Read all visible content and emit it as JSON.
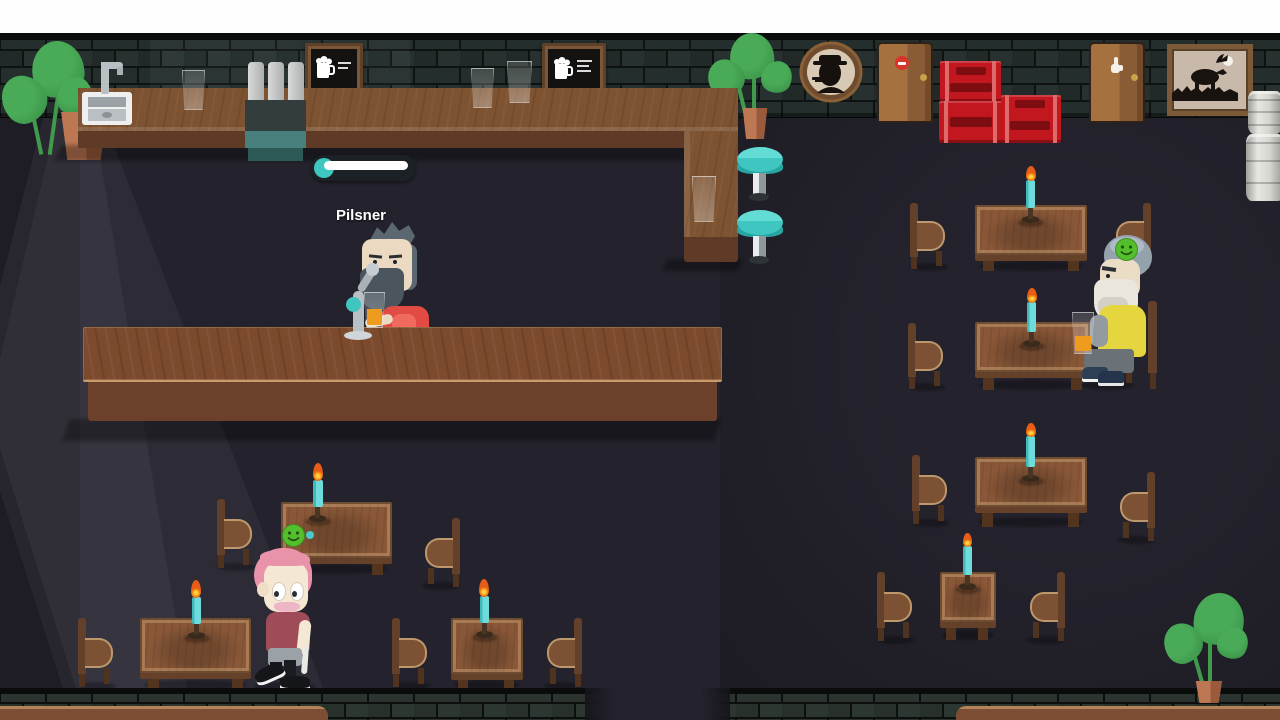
{
  "hud": {
    "beer_label": "Pilsner",
    "progress": {
      "percent": 88,
      "track_color": "#1c2125",
      "fill_color": "#ffffff",
      "bubble_color": "#3cc8c2"
    }
  },
  "characters": {
    "bartender": {
      "role": "bartender",
      "action": "pouring-beer",
      "shirt_color": "#e24a44",
      "hair_color": "#5c6871"
    },
    "seated_customer": {
      "mood": "happy",
      "shirt_color": "#e5d53e",
      "beard_color": "#eae6de",
      "drink": "beer-glass"
    },
    "walking_customer": {
      "hair_color": "#e993ab",
      "shirt_color": "#a04b58"
    }
  },
  "indicators": {
    "happy_smiley_color": "#54bf2c",
    "bubble_dot_color": "#49c9c9"
  },
  "wall_decor": {
    "sign_left_icon": "beer-mug-icon",
    "sign_right_icon": "beer-mug-icon",
    "portrait_icon": "detective-silhouette",
    "painting_icon": "moose-silhouette",
    "door_left_icon": "no-entry-icon",
    "door_right_icon": "hand-icon"
  },
  "scene": {
    "tables_right": 4,
    "tables_left": 3,
    "bar_stools": 2,
    "beer_crates": 3,
    "kegs": 2,
    "plants": 3,
    "candles_lit": 7
  },
  "palette": {
    "teal": "#3fc6c0",
    "candle": "#6fdbdb",
    "flame": "#f59a1c",
    "crate": "#c3171f",
    "smiley": "#54bf2c",
    "wood": "#7d5331",
    "wood-dark": "#5f3a26",
    "counter": "#7c4a2d",
    "floor": "#24222c"
  }
}
